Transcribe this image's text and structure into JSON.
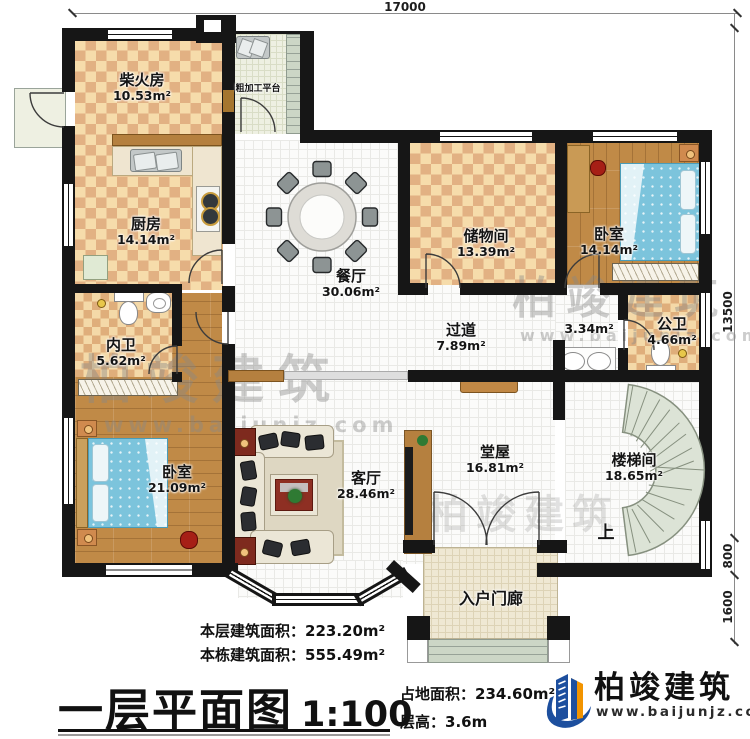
{
  "dimensions": {
    "top": "17000",
    "right_main": "13500",
    "right_mid": "800",
    "right_low": "1600"
  },
  "rooms": {
    "chaihuofang": {
      "name": "柴火房",
      "area": "10.53m²"
    },
    "cujiagong": {
      "name": "粗加工平台"
    },
    "chufang": {
      "name": "厨房",
      "area": "14.14m²"
    },
    "neiwei": {
      "name": "内卫",
      "area": "5.62m²"
    },
    "woshi_left": {
      "name": "卧室",
      "area": "21.09m²"
    },
    "canting": {
      "name": "餐厅",
      "area": "30.06m²"
    },
    "chuwujian": {
      "name": "储物间",
      "area": "13.39m²"
    },
    "woshi_right": {
      "name": "卧室",
      "area": "14.14m²"
    },
    "guodao": {
      "name": "过道",
      "area": "7.89m²"
    },
    "xishoutai": {
      "area": "3.34m²"
    },
    "gongwei": {
      "name": "公卫",
      "area": "4.66m²"
    },
    "tangwu": {
      "name": "堂屋",
      "area": "16.81m²"
    },
    "keting": {
      "name": "客厅",
      "area": "28.46m²"
    },
    "loutijian": {
      "name": "楼梯间",
      "area": "18.65m²"
    },
    "rumenlang": {
      "name": "入户门廊"
    },
    "stair_up": {
      "label": "上"
    }
  },
  "footer": {
    "floor_area_label": "本层建筑面积：",
    "floor_area_value": "223.20m²",
    "building_area_label": "本栋建筑面积：",
    "building_area_value": "555.49m²",
    "title": "一层平面图",
    "scale": "1:100",
    "land_area_label": "占地面积：",
    "land_area_value": "234.60m²",
    "height_label": "层高：",
    "height_value": "3.6m"
  },
  "brand": {
    "name": "柏竣建筑",
    "url": "www.baijunjz.com"
  },
  "watermark": {
    "name": "柏竣建筑",
    "url": "www.baijunjz.com"
  },
  "colors": {
    "wall": "#161616",
    "checker_light": "#f6dcab",
    "checker_dark": "#e2b183",
    "wood": "#c08a47",
    "bed_blue": "#7cc4dc",
    "stair_green": "#dce3d6",
    "brand_blue": "#1d4f9e",
    "brand_orange": "#f29400"
  }
}
